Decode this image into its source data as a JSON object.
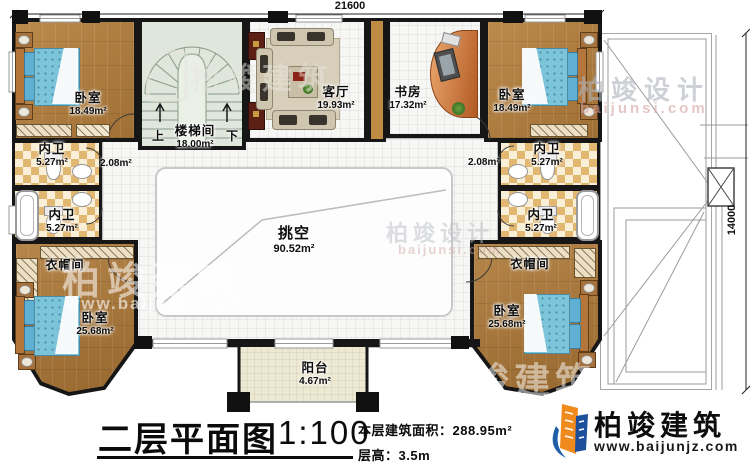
{
  "plan": {
    "dim_top": "21600",
    "dim_right": "14000",
    "rooms": {
      "bedroom_tl": {
        "name": "卧室",
        "area": "18.49m²"
      },
      "staircase": {
        "name": "楼梯间",
        "area": "18.00m²",
        "up_label": "上",
        "down_label": "下"
      },
      "living": {
        "name": "客厅",
        "area": "19.93m²"
      },
      "study": {
        "name": "书房",
        "area": "17.32m²"
      },
      "bedroom_tr": {
        "name": "卧室",
        "area": "18.49m²"
      },
      "bath_l1": {
        "name": "内卫",
        "area": "5.27m²"
      },
      "bath_l2": {
        "name": "内卫",
        "area": "5.27m²"
      },
      "bath_r1": {
        "name": "内卫",
        "area": "5.27m²"
      },
      "bath_r2": {
        "name": "内卫",
        "area": "5.27m²"
      },
      "corridor_l": {
        "area": "2.08m²"
      },
      "corridor_r": {
        "area": "2.08m²"
      },
      "closet_l": {
        "name": "衣帽间"
      },
      "closet_r": {
        "name": "衣帽间"
      },
      "bedroom_bl": {
        "name": "卧室",
        "area": "25.68m²"
      },
      "bedroom_br": {
        "name": "卧室",
        "area": "25.68m²"
      },
      "void": {
        "name": "挑空",
        "area": "90.52m²"
      },
      "balcony": {
        "name": "阳台",
        "area": "4.67m²"
      }
    }
  },
  "titleblock": {
    "title": "二层平面图",
    "scale": "1:100",
    "area_line": "本层建筑面积：288.95m²",
    "height_line": "层高：3.5m"
  },
  "brand": {
    "name": "柏竣建筑",
    "url": "www.baijunjz.com"
  },
  "watermarks": {
    "design_name": "柏竣设计",
    "design_url": "baijunsi.com",
    "build_name": "柏竣建筑",
    "build_url": "www.baijunjz.com"
  },
  "colors": {
    "wall": "#161616",
    "wood": "#b28040",
    "bed": "#7cc4da",
    "brand_blue": "#1f5fa8",
    "brand_orange": "#f08a1c"
  }
}
